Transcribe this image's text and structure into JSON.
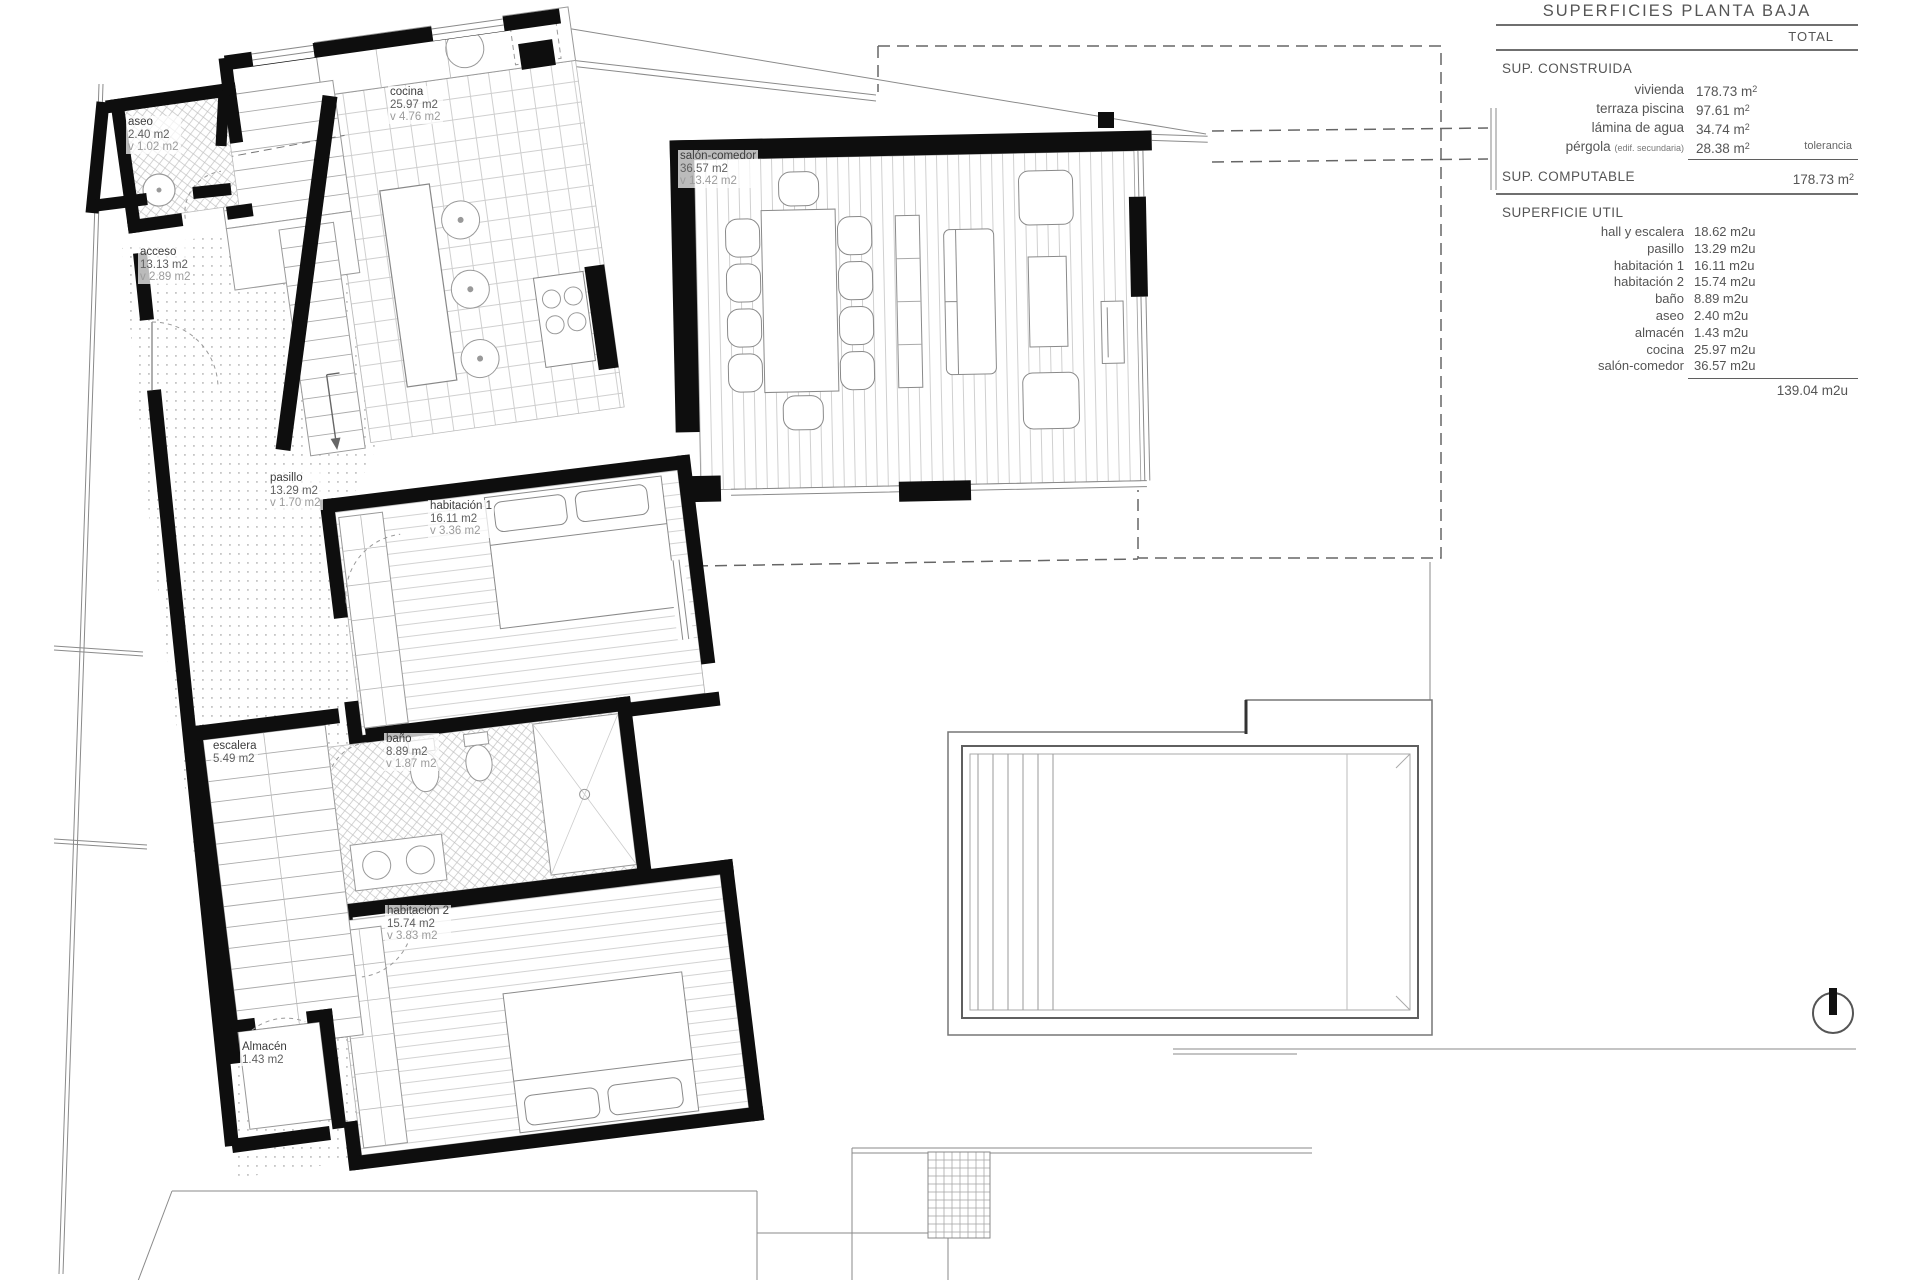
{
  "panel": {
    "title": "SUPERFICIES PLANTA BAJA",
    "total_header": "TOTAL",
    "constructed": {
      "heading": "SUP. CONSTRUIDA",
      "rows": [
        {
          "label": "vivienda",
          "value": "178.73",
          "unit": "m2"
        },
        {
          "label": "terraza piscina",
          "value": "97.61",
          "unit": "m2"
        },
        {
          "label": "lámina de agua",
          "value": "34.74",
          "unit": "m2"
        },
        {
          "label": "pérgola",
          "label_note": "(edif. secundaria)",
          "value": "28.38",
          "unit": "m2",
          "side_note": "tolerancia"
        }
      ]
    },
    "computable": {
      "label": "SUP. COMPUTABLE",
      "value": "178.73",
      "unit": "m2"
    },
    "useful": {
      "heading": "SUPERFICIE UTIL",
      "rows": [
        {
          "label": "hall y escalera",
          "value": "18.62 m2u"
        },
        {
          "label": "pasillo",
          "value": "13.29 m2u"
        },
        {
          "label": "habitación 1",
          "value": "16.11 m2u"
        },
        {
          "label": "habitación 2",
          "value": "15.74 m2u"
        },
        {
          "label": "baño",
          "value": "8.89 m2u"
        },
        {
          "label": "aseo",
          "value": "2.40 m2u"
        },
        {
          "label": "almacén",
          "value": "1.43 m2u"
        },
        {
          "label": "cocina",
          "value": "25.97 m2u"
        },
        {
          "label": "salón-comedor",
          "value": "36.57 m2u"
        }
      ],
      "total": "139.04 m2u"
    }
  },
  "plan": {
    "rooms": [
      {
        "name": "aseo",
        "area": "2.40 m2",
        "vent": "v 1.02 m2",
        "x": 126,
        "y": 116
      },
      {
        "name": "acceso",
        "area": "13.13 m2",
        "vent": "v 2.89 m2",
        "x": 138,
        "y": 246
      },
      {
        "name": "cocina",
        "area": "25.97 m2",
        "vent": "v 4.76 m2",
        "x": 388,
        "y": 86
      },
      {
        "name": "salón-comedor",
        "area": "36.57 m2",
        "vent": "v 13.42 m2",
        "x": 678,
        "y": 150
      },
      {
        "name": "pasillo",
        "area": "13.29 m2",
        "vent": "v 1.70 m2",
        "x": 268,
        "y": 472
      },
      {
        "name": "habitación 1",
        "area": "16.11 m2",
        "vent": "v 3.36 m2",
        "x": 428,
        "y": 500
      },
      {
        "name": "baño",
        "area": "8.89 m2",
        "vent": "v 1.87 m2",
        "x": 384,
        "y": 733
      },
      {
        "name": "escalera",
        "area": "5.49 m2",
        "vent": "",
        "x": 211,
        "y": 740
      },
      {
        "name": "habitación 2",
        "area": "15.74 m2",
        "vent": "v 3.83 m2",
        "x": 385,
        "y": 905
      },
      {
        "name": "Almacén",
        "area": "1.43 m2",
        "vent": "",
        "x": 240,
        "y": 1041
      }
    ]
  }
}
